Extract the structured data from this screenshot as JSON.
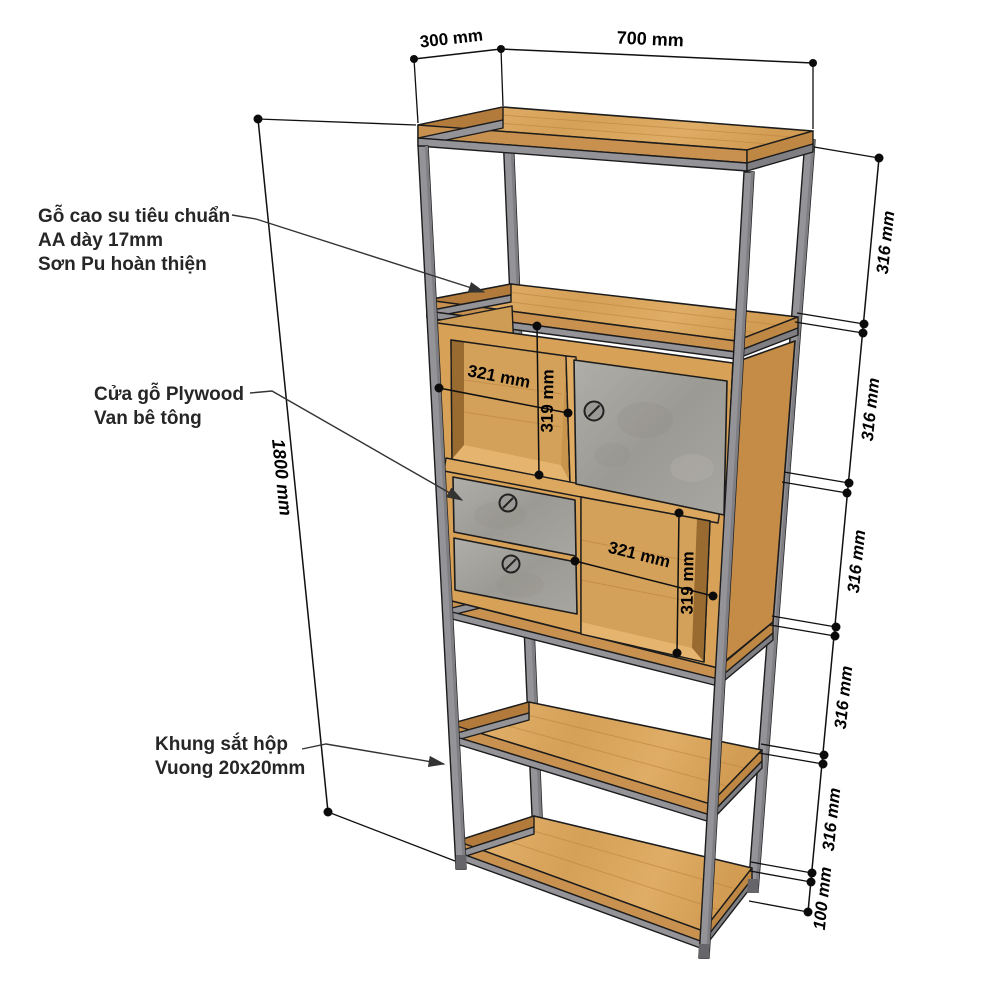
{
  "annotations": {
    "shelf_material": {
      "lines": [
        "Gỗ cao su tiêu chuẩn",
        "AA dày 17mm",
        "Sơn Pu hoàn thiện"
      ]
    },
    "door_material": {
      "lines": [
        "Cửa gỗ Plywood",
        "Van bê tông"
      ]
    },
    "frame_material": {
      "lines": [
        "Khung sắt hộp",
        "Vuong 20x20mm"
      ]
    }
  },
  "dimensions": {
    "top_depth": "300 mm",
    "top_width": "700 mm",
    "overall_height": "1800 mm",
    "right_segments": [
      "316 mm",
      "316 mm",
      "316 mm",
      "316 mm",
      "316 mm"
    ],
    "right_bottom_segment": "100 mm",
    "upper_compartment": {
      "width": "321 mm",
      "height": "319 mm"
    },
    "lower_compartment": {
      "width": "321 mm",
      "height": "319 mm"
    }
  },
  "colors": {
    "wood": "#D9A45F",
    "wood_dark": "#B27A3B",
    "concrete": "#A3A19B",
    "metal_frame": "#939398",
    "dimension_line": "#111111"
  }
}
